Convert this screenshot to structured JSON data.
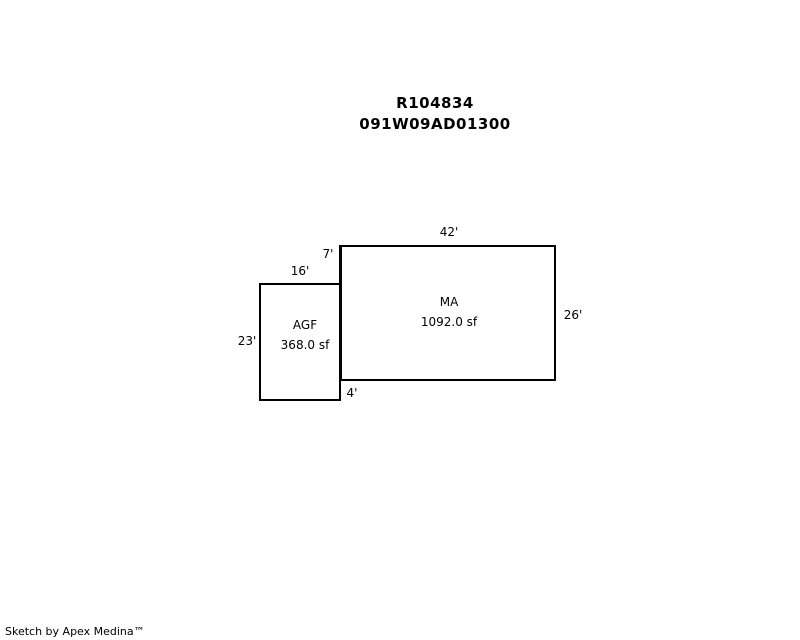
{
  "header": {
    "line1": "R104834",
    "line2": "091W09AD01300"
  },
  "sketch": {
    "shapes": {
      "ma": {
        "label": "MA",
        "area": "1092.0 sf",
        "width_ft": 42,
        "height_ft": 26
      },
      "agf": {
        "label": "AGF",
        "area": "368.0 sf",
        "width_ft": 16,
        "height_ft": 23
      }
    },
    "dimensions": {
      "ma_top": "42'",
      "ma_right": "26'",
      "ma_left_upper": "7'",
      "agf_top": "16'",
      "agf_left": "23'",
      "agf_right_lower": "4'"
    }
  },
  "footer": {
    "credit": "Sketch by Apex Medina™"
  },
  "colors": {
    "background": "#ffffff",
    "line": "#000000",
    "text": "#000000"
  }
}
